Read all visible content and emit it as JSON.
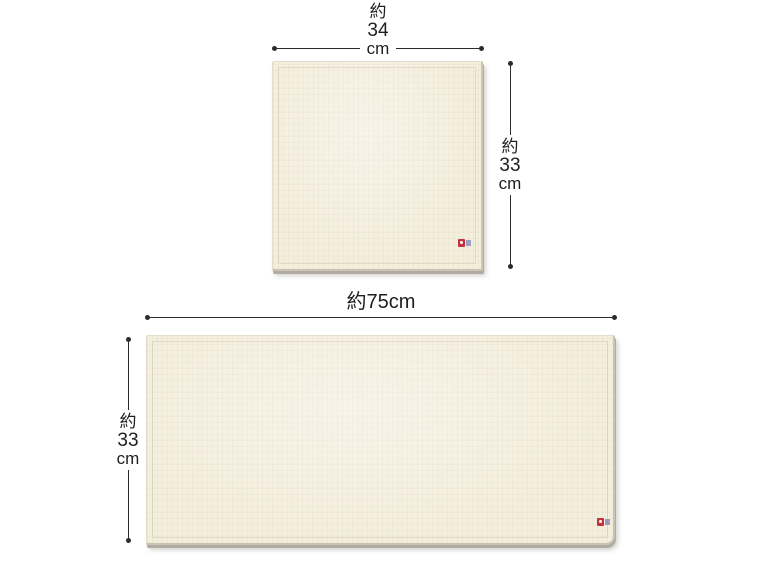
{
  "colors": {
    "background": "#ffffff",
    "towel_fill": "#f4eedd",
    "towel_hem": "#e0d8c2",
    "towel_edge": "#c9c4b3",
    "towel_shadow": "#b0aca1",
    "dimension_line": "#2b2b2b",
    "label_text": "#1f1f1f",
    "tag_red": "#c0333e",
    "tag_blue": "#9aa2bd"
  },
  "small_towel": {
    "width_dimension": {
      "approx": "約",
      "value": "34",
      "unit": "cm"
    },
    "height_dimension": {
      "approx": "約",
      "value": "33",
      "unit": "cm"
    }
  },
  "large_towel": {
    "width_dimension": {
      "label": "約75cm"
    },
    "height_dimension": {
      "approx": "約",
      "value": "33",
      "unit": "cm"
    }
  }
}
